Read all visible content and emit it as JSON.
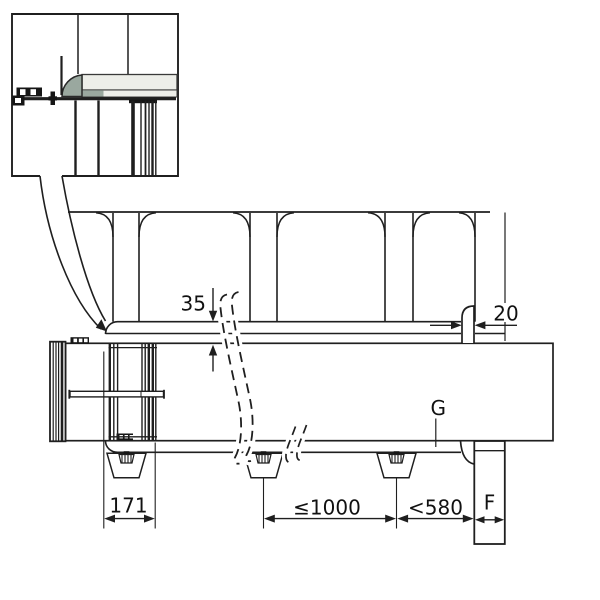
{
  "drawing": {
    "type": "technical-elevation-awning-mounting",
    "labels": {
      "rail_offset": "35",
      "hook_clearance": "20",
      "first_bracket_distance": "171",
      "bracket_spacing": "≤1000",
      "end_bracket_distance": "<580",
      "post_width": "F",
      "guide_rail": "G"
    },
    "colors": {
      "ink": "#1f1f1f",
      "panel_light": "#edeee9",
      "panel_sage": "#9aa89f",
      "background": "#ffffff"
    }
  }
}
